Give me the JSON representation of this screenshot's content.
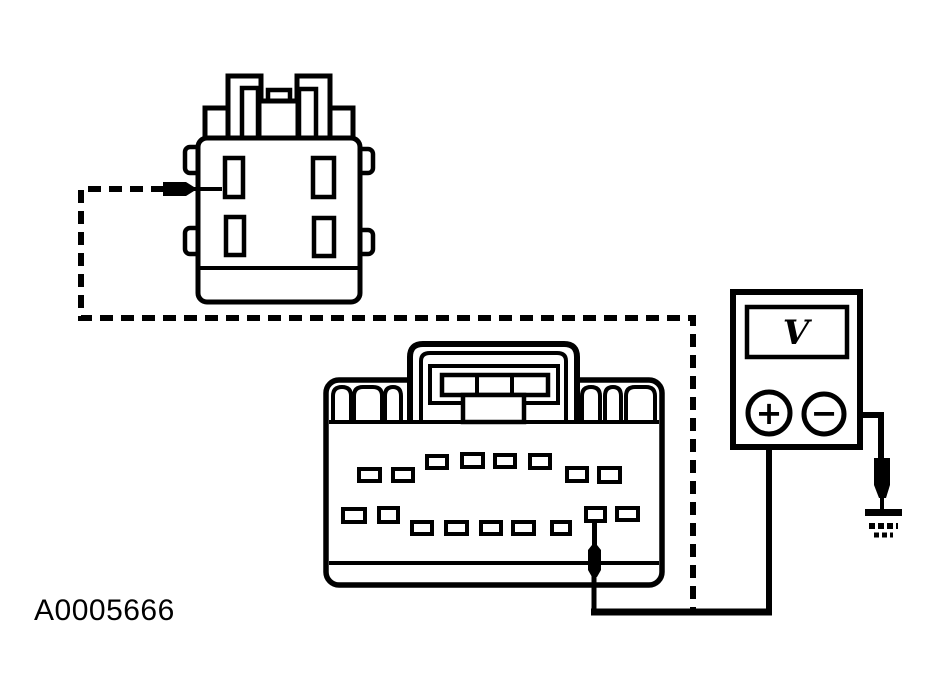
{
  "colors": {
    "ink": "#000000",
    "paper": "#ffffff"
  },
  "figure_label": "A0005666",
  "voltmeter": {
    "display_symbol": "V",
    "positive_label": "+",
    "negative_label": "−"
  },
  "icons": {
    "jumper": "dashed-jumper-wire",
    "relay_probe": "test-probe-icon",
    "connector_probe": "test-probe-icon",
    "ground_probe": "test-probe-icon",
    "ground": "earth-ground-icon",
    "plus_terminal": "plus-terminal-icon",
    "minus_terminal": "minus-terminal-icon"
  }
}
